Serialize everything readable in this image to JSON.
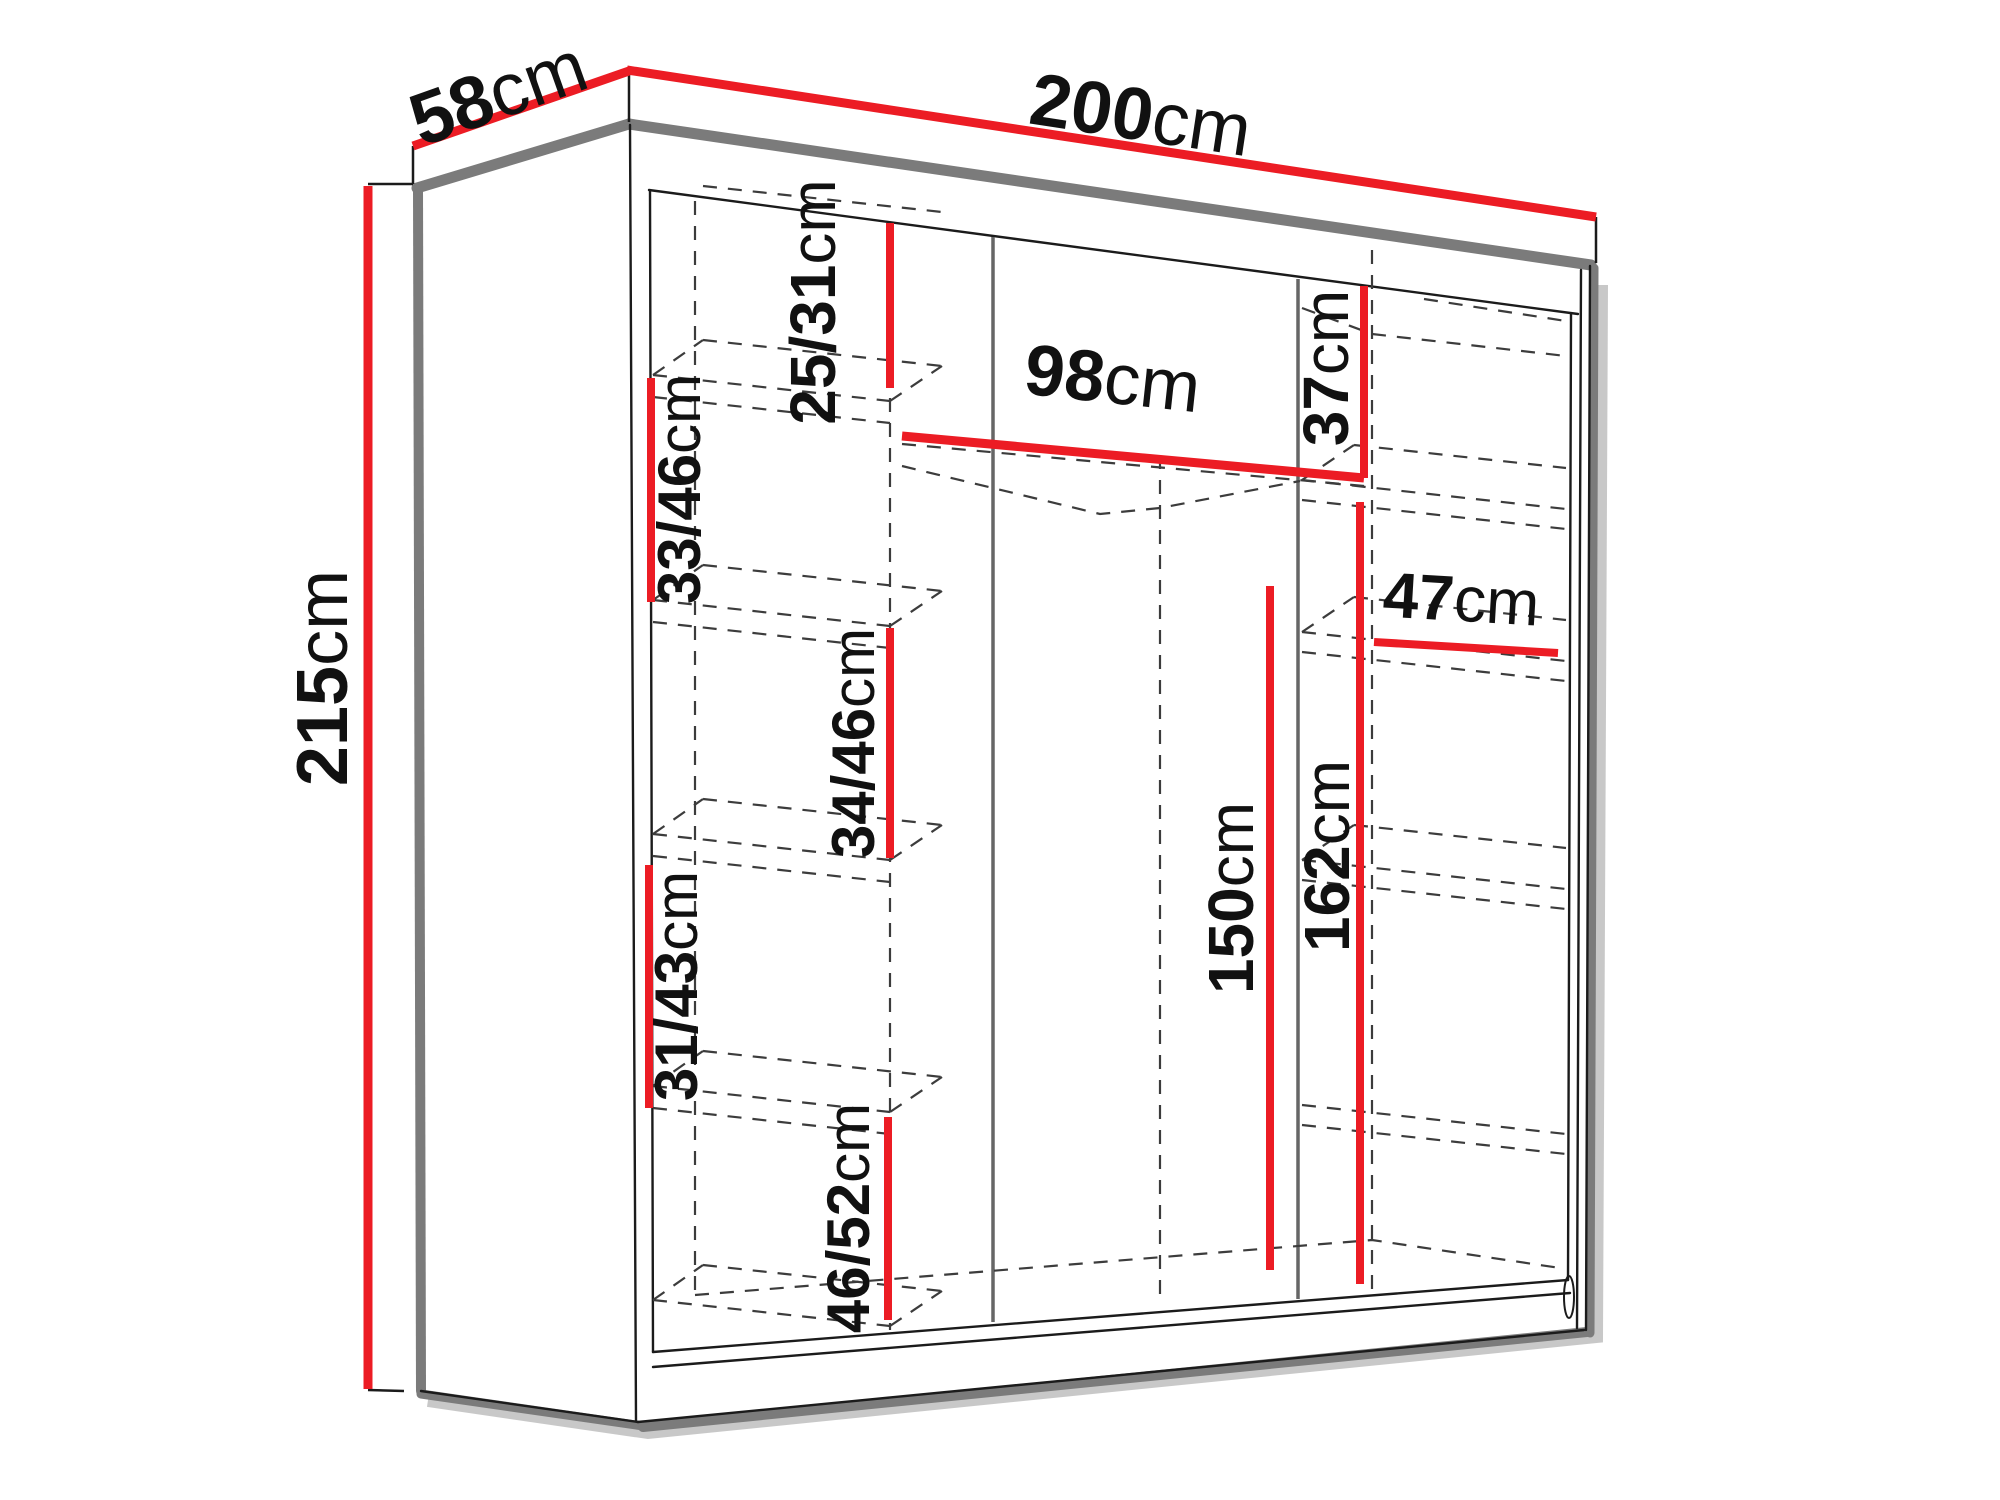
{
  "diagram": {
    "type": "furniture-dimension-diagram",
    "subject": "Sliding-door wardrobe with interior shelf dimensions",
    "unit": "cm",
    "colors": {
      "dimension_line": "#ec1c24",
      "outline": "#1b1b1b",
      "edge_shadow": "#7b7b7b",
      "hidden_edge": "#3c3c3c",
      "background": "#ffffff",
      "text": "#111111"
    },
    "dimensions": {
      "depth": {
        "value": "58",
        "unit": "cm"
      },
      "width": {
        "value": "200",
        "unit": "cm"
      },
      "height": {
        "value": "215",
        "unit": "cm"
      },
      "top_shelf_height": {
        "value": "25/31",
        "unit": "cm"
      },
      "left_shelf_1": {
        "value": "33/46",
        "unit": "cm"
      },
      "left_shelf_2": {
        "value": "34/46",
        "unit": "cm"
      },
      "left_shelf_3": {
        "value": "31/43",
        "unit": "cm"
      },
      "left_shelf_4": {
        "value": "46/52",
        "unit": "cm"
      },
      "hanging_width": {
        "value": "98",
        "unit": "cm"
      },
      "right_top_height": {
        "value": "37",
        "unit": "cm"
      },
      "right_shelf_width": {
        "value": "47",
        "unit": "cm"
      },
      "hanging_height": {
        "value": "150",
        "unit": "cm"
      },
      "middle_height": {
        "value": "162",
        "unit": "cm"
      }
    }
  }
}
